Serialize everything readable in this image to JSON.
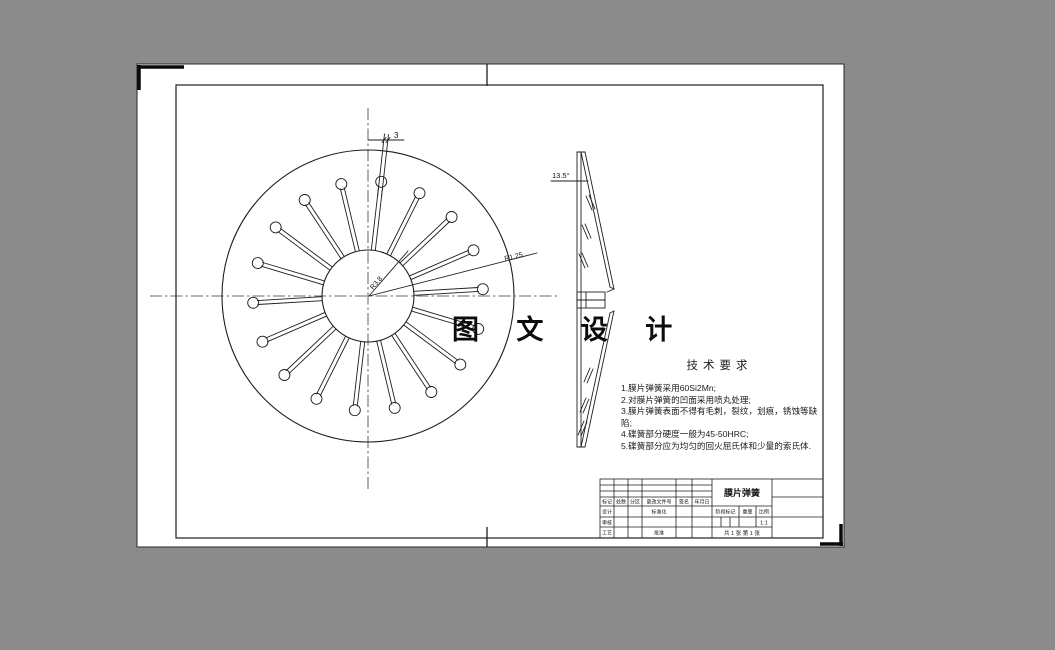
{
  "colors": {
    "background": "#8b8b8b",
    "sheet": "#ffffff",
    "line": "#1e1e1e"
  },
  "watermark": {
    "text": "图 文 设 计"
  },
  "tech_requirements": {
    "title": "技术要求",
    "items": [
      "1.膜片弹簧采用60Si2Mn;",
      "2.对膜片弹簧的凹面采用喷丸处理;",
      "3.膜片弹簧表面不得有毛刺，裂纹，划痕，锈蚀等缺陷;",
      "4.碟簧部分硬度一般为45-50HRC;",
      "5.碟簧部分应为均匀的回火屈氏体和少量的索氏体."
    ]
  },
  "drawing": {
    "front": {
      "cx": 368,
      "cy": 296,
      "outer_r": 146,
      "inner_r": 46,
      "hole_r": 5.5,
      "hole_dist": 115,
      "slot_count": 18,
      "angle_offset_deg": 83.4,
      "slot_half_width": 2
    },
    "labels": {
      "slot_width": "3",
      "tip_radius": "R1.25",
      "root_radius": "R3.8",
      "cone_angle": "13.5°"
    }
  },
  "title_block": {
    "part_name": "膜片弹簧",
    "revision_headers": [
      "标记",
      "处数",
      "分区",
      "更改文件号",
      "签名",
      "年月日"
    ],
    "roles": {
      "design": "设计",
      "standardize": "标准化",
      "check": "审核",
      "process": "工艺",
      "approve": "批准"
    },
    "stage_header": "阶段标记",
    "weight_header": "重量",
    "scale_header": "比例",
    "scale_value": "1:1",
    "sheet_info": "共 1 张 第 1 张"
  }
}
